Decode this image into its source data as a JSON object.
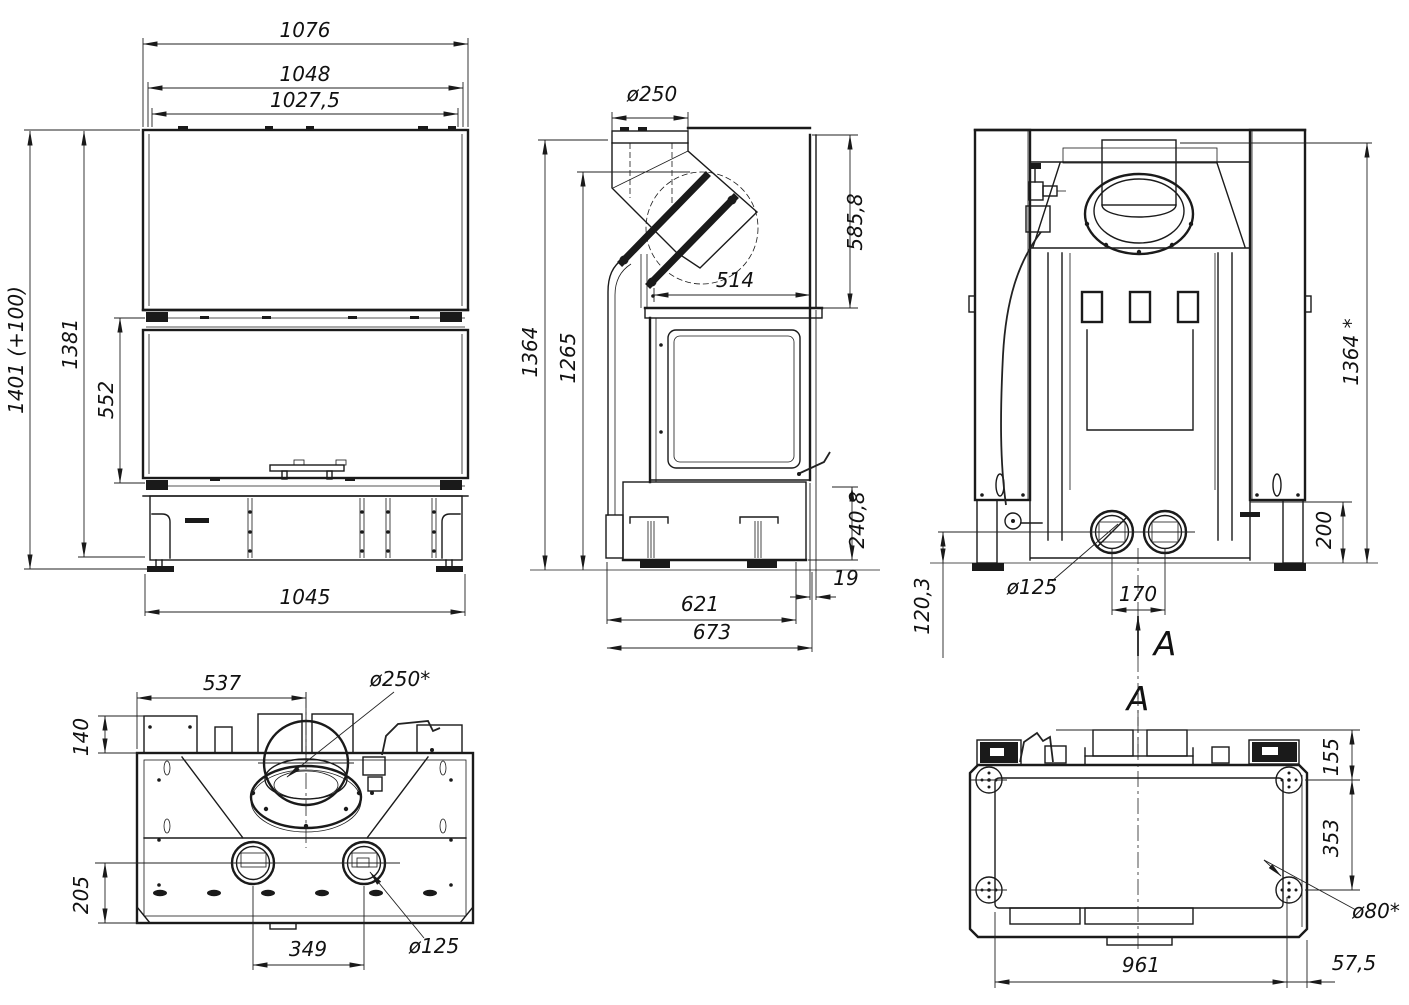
{
  "drawing": {
    "background": "#ffffff",
    "line_color": "#1a1a1a",
    "views": {
      "front": {
        "name": "front-view",
        "dims": {
          "overall_width": "1076",
          "frame_width": "1048",
          "glass_width": "1027,5",
          "total_height": "1401 (+100)",
          "body_height": "1381",
          "door_height": "552",
          "base_width": "1045"
        }
      },
      "side": {
        "name": "side-view",
        "dims": {
          "flue_diameter": "ø250",
          "hood_height": "585,8",
          "top_depth": "514",
          "overall_height": "1364",
          "glass_top_height": "1265",
          "handle_height": "240,8",
          "rear_gap": "19",
          "base_depth": "621",
          "overall_depth": "673"
        }
      },
      "rear": {
        "name": "rear-view",
        "dims": {
          "overall_height": "1364 *",
          "outlet_top_height": "200",
          "outlet_diameter": "ø125",
          "outlet_spacing": "170",
          "outlet_axis_height": "120,3"
        },
        "section_arrow_label": "A",
        "section_view_label": "A"
      },
      "top": {
        "name": "top-view",
        "dims": {
          "collar_axis_offset": "537",
          "collar_diameter": "ø250*",
          "rear_ledge_depth": "140",
          "outlet_axis_offset": "205",
          "outlet_spacing": "349",
          "outlet_diameter": "ø125"
        }
      },
      "bottom": {
        "name": "bottom-view",
        "dims": {
          "foot_axis_from_rear": "155",
          "foot_spacing_depth": "353",
          "foot_diameter": "ø80*",
          "foot_spacing_width": "961",
          "foot_axis_from_side": "57,5"
        }
      }
    }
  }
}
